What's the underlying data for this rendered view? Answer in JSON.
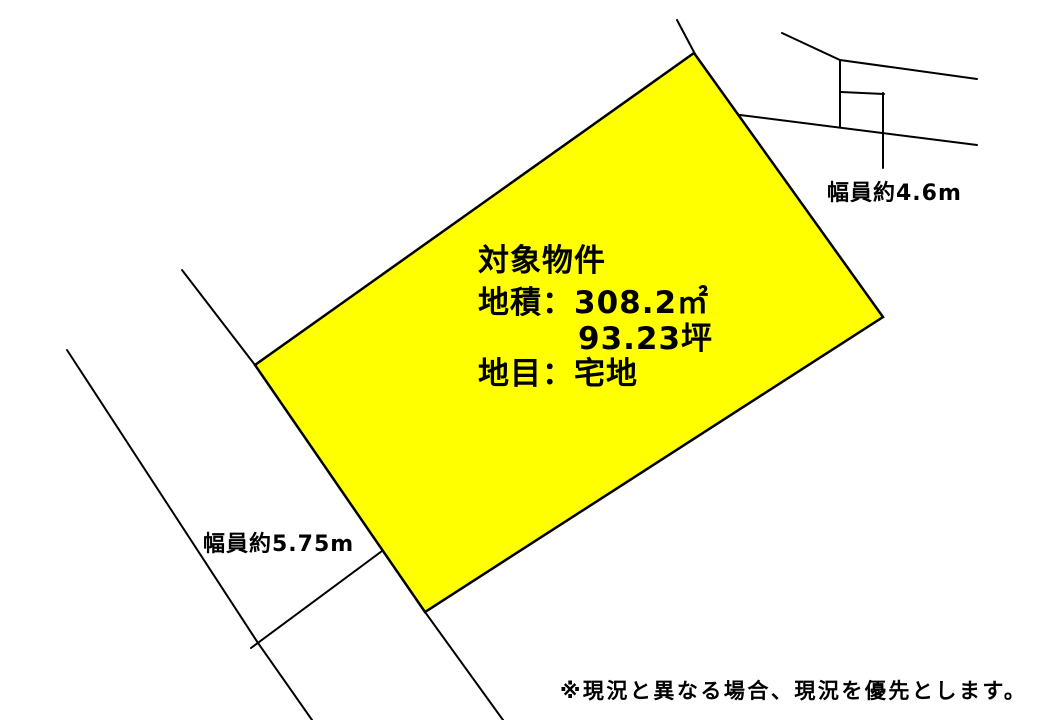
{
  "colors": {
    "background": "#ffffff",
    "line": "#000000",
    "text": "#000000",
    "parcel_fill": "#ffff00"
  },
  "parcel": {
    "title": "対象物件",
    "area": "地積：308.2㎡",
    "area_tsubo": "93.23坪",
    "category": "地目：宅地"
  },
  "roads": {
    "north_width": "幅員約4.6m",
    "west_width": "幅員約5.75m"
  },
  "disclaimer": "※現況と異なる場合、現況を優先とします。"
}
